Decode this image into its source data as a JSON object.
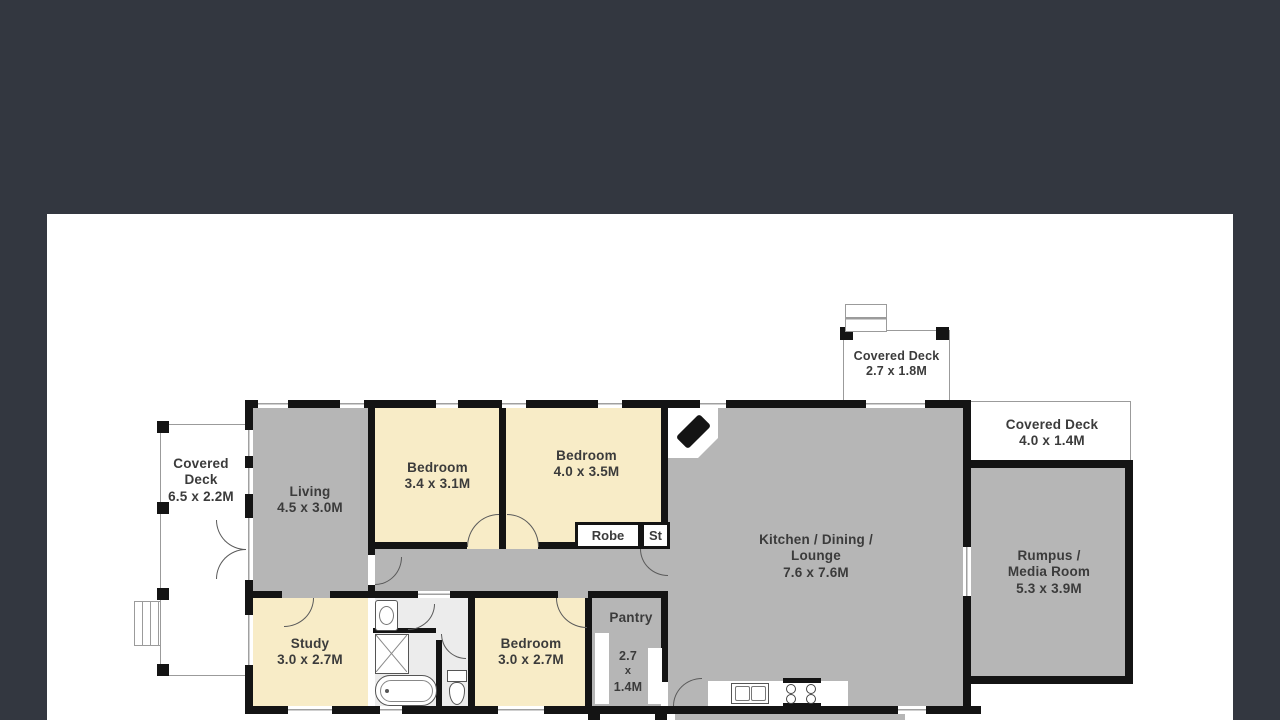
{
  "viewer": {
    "backdrop_color": "#333740",
    "page_color": "#ffffff"
  },
  "colors": {
    "wall": "#141414",
    "floor_gray": "#b6b6b6",
    "floor_cream": "#f8ecc7",
    "bath_floor": "#ececec",
    "label_text": "#3b3b3b",
    "deck_outline": "#9b9b9b"
  },
  "plan": {
    "decks": {
      "left": {
        "name_line1": "Covered",
        "name_line2": "Deck",
        "dims": "6.5 x 2.2M"
      },
      "top": {
        "name": "Covered Deck",
        "dims": "2.7 x 1.8M"
      },
      "right": {
        "name": "Covered Deck",
        "dims": "4.0 x 1.4M"
      }
    },
    "rooms": {
      "living": {
        "name": "Living",
        "dims": "4.5 x 3.0M"
      },
      "bedroom_front_left": {
        "name": "Bedroom",
        "dims": "3.4 x 3.1M"
      },
      "bedroom_front_right": {
        "name": "Bedroom",
        "dims": "4.0 x 3.5M"
      },
      "kitchen": {
        "name_line1": "Kitchen / Dining /",
        "name_line2": "Lounge",
        "dims": "7.6 x 7.6M"
      },
      "rumpus": {
        "name_line1": "Rumpus /",
        "name_line2": "Media Room",
        "dims": "5.3 x 3.9M"
      },
      "study": {
        "name": "Study",
        "dims": "3.0 x 2.7M"
      },
      "bedroom_rear": {
        "name": "Bedroom",
        "dims": "3.0 x 2.7M"
      },
      "pantry": {
        "name": "Pantry",
        "dims_line1": "2.7",
        "dims_line2": "x",
        "dims_line3": "1.4M"
      },
      "robe": {
        "name": "Robe"
      },
      "store": {
        "name": "St"
      }
    },
    "icons": {
      "fireplace": "black angled corner wood-heater",
      "bathtub": "rounded-rect tub outline",
      "shower": "square with X",
      "toilet": "tank + bowl outline",
      "vanity-sink": "rect with oval basin",
      "kitchen-sink": "double-basin rect",
      "cooktop": "4-burner hob",
      "steps": "striped step treads",
      "door-arc": "quarter-circle swing",
      "window": "white break with mullion line"
    }
  }
}
